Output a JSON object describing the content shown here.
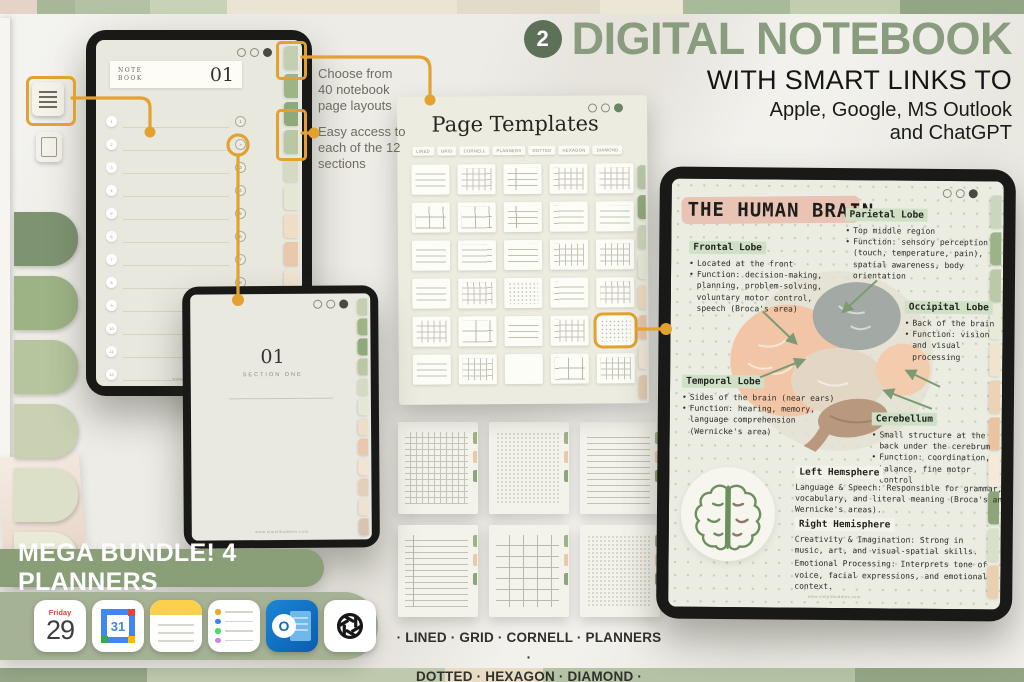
{
  "header": {
    "badge": "2",
    "title": "DIGITAL NOTEBOOK",
    "subtitle": "WITH SMART LINKS TO",
    "apps_line1": "Apple, Google, MS Outlook",
    "apps_line2": "and ChatGPT"
  },
  "callouts": {
    "layouts": "Choose from\n40 notebook\npage layouts",
    "sections": "Easy access to\neach of the 12\nsections"
  },
  "notebook_tablet": {
    "label_line1": "NOTE",
    "label_line2": "BOOK",
    "page_number": "01",
    "row_count": 12
  },
  "section_page": {
    "number": "01",
    "title": "SECTION ONE"
  },
  "templates_panel": {
    "title": "Page Templates",
    "filters": [
      "Lined",
      "Grid",
      "Cornell",
      "Planners",
      "Dotted",
      "Hexagon",
      "Diamond"
    ],
    "thumbnails": [
      "lined",
      "grid",
      "cornell",
      "grid",
      "grid",
      "boxes",
      "boxes",
      "cornell",
      "lined",
      "lined",
      "lined",
      "lined",
      "lined",
      "grid",
      "grid",
      "lined",
      "grid",
      "dots",
      "lined",
      "grid",
      "grid",
      "boxes",
      "lined",
      "grid",
      "dots",
      "lined",
      "grid",
      "blank",
      "boxes",
      "grid"
    ],
    "highlight_index": 24
  },
  "page_previews": [
    "grid",
    "dots",
    "lined",
    "cornell",
    "boxes",
    "dots"
  ],
  "brain_page": {
    "title": "THE HUMAN BRAIN",
    "sections": [
      {
        "label": "Frontal Lobe",
        "bullets": [
          "Located at the front",
          "Function: decision-making, planning, problem-solving, voluntary motor control, speech (Broca's area)"
        ]
      },
      {
        "label": "Parietal Lobe",
        "bullets": [
          "Top middle region",
          "Function: sensory perception (touch, temperature, pain), spatial awareness, body orientation"
        ]
      },
      {
        "label": "Occipital Lobe",
        "bullets": [
          "Back of the brain",
          "Function: vision and visual processing"
        ]
      },
      {
        "label": "Temporal Lobe",
        "bullets": [
          "Sides of the brain (near ears)",
          "Function: hearing, memory, language comprehension (Wernicke's area)"
        ]
      },
      {
        "label": "Cerebellum",
        "bullets": [
          "Small structure at the back under the cerebrum",
          "Function: coordination, balance, fine motor control"
        ]
      }
    ],
    "hemispheres": {
      "left": {
        "label": "Left Hemsphere",
        "text": "Language & Speech: Responsible for grammar, vocabulary, and literal meaning (Broca's and Wernicke's areas)."
      },
      "right": {
        "label": "Right Hemisphere",
        "text1": "Creativity & Imagination: Strong in music, art, and visual-spatial skills.",
        "text2": "Emotional Processing: Interprets tone of voice, facial expressions, and emotional context."
      }
    }
  },
  "watermark": "www.simplibuddies.com",
  "banner": "MEGA BUNDLE! 4 PLANNERS",
  "dock": {
    "calendar": {
      "weekday": "Friday",
      "day": "29"
    },
    "gcal_day": "31",
    "outlook_letter": "O",
    "apps": [
      "apple-calendar",
      "google-calendar",
      "apple-notes",
      "apple-reminders",
      "ms-outlook",
      "chatgpt"
    ]
  },
  "footer": {
    "line1": "· LINED · GRID · CORNELL · PLANNERS ·",
    "line2": "DOTTED · HEXAGON · DIAMOND ·"
  },
  "colors": {
    "accent_orange": "#e3a230",
    "title_green": "#8a9c7e",
    "badge_green": "#5c7158",
    "banner_green": "#8a9e78",
    "dock_green": "#a6b295",
    "label_highlight": "#cfe0c6",
    "title_highlight": "#e9c3b4"
  }
}
